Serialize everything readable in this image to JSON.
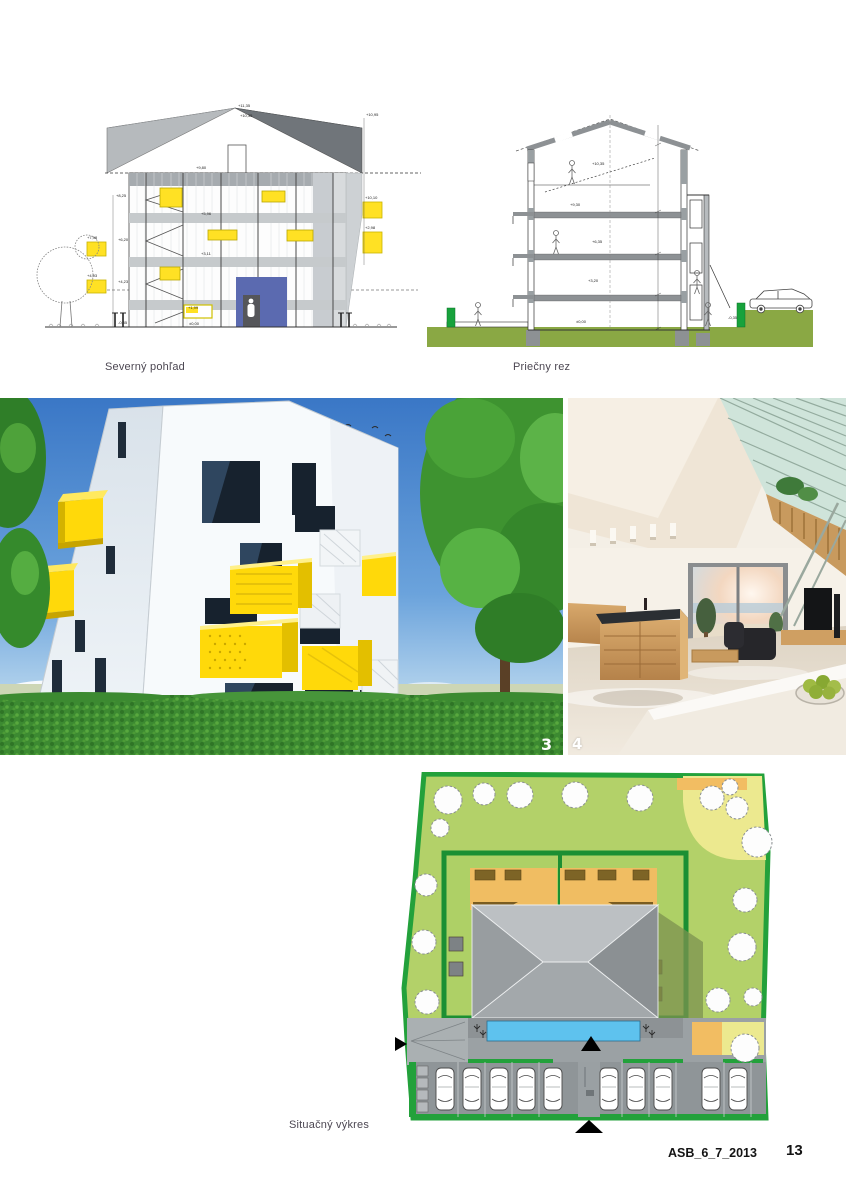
{
  "page": {
    "footer_reference": "ASB_6_7_2013",
    "page_number": "13"
  },
  "figures": {
    "elevation": {
      "caption": "Severný pohľad",
      "dims": [
        "+11,35",
        "+10,35",
        "+10,95",
        "+9,80",
        "+8,25",
        "+7,98",
        "+6,20",
        "+5,96",
        "+4,93",
        "+4,23",
        "+3,11",
        "+1,99",
        "±0,00",
        "-0,35",
        "+10,10",
        "+2,98"
      ]
    },
    "section": {
      "caption": "Priečny rez",
      "dims": [
        "+10,35",
        "+9,30",
        "+6,35",
        "+3,20",
        "±0,00",
        "-0,35"
      ]
    },
    "render_exterior": {
      "badge": "3"
    },
    "render_interior": {
      "badge": "4"
    },
    "siteplan": {
      "caption": "Situačný výkres"
    }
  },
  "colors": {
    "accent_yellow": "#ffdf00",
    "entrance_blue": "#5b6ab0",
    "site_green": "#b3d169",
    "boundary_green": "#23a13b",
    "hedge_green": "#1b8f33",
    "pool_blue": "#5ec2ee",
    "terrace_orange": "#f0bd62",
    "ground_olive": "#8aa844",
    "roof_gray": "#9aa0a3"
  }
}
